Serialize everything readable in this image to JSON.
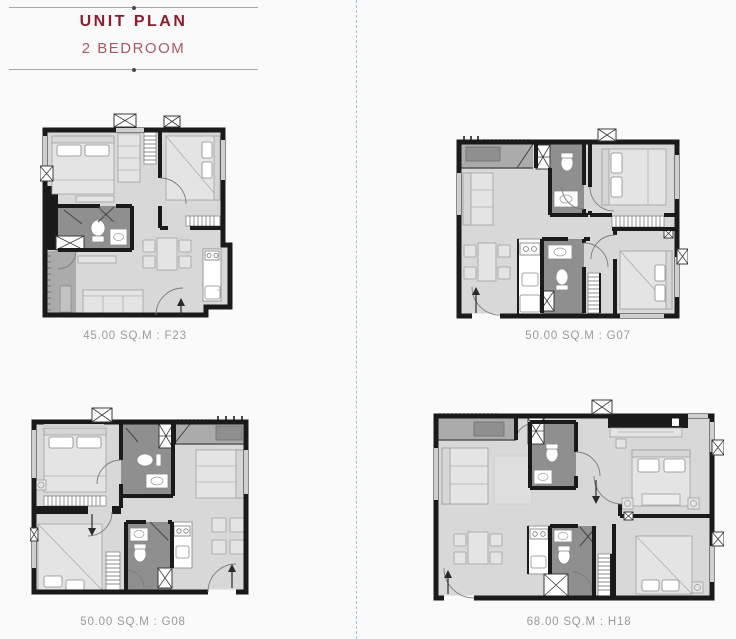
{
  "header": {
    "title": "UNIT PLAN",
    "subtitle": "2 BEDROOM"
  },
  "units": [
    {
      "area_sqm": "45.00",
      "unit_code": "F23",
      "caption": "45.00 SQ.M : F23"
    },
    {
      "area_sqm": "50.00",
      "unit_code": "G07",
      "caption": "50.00 SQ.M : G07"
    },
    {
      "area_sqm": "50.00",
      "unit_code": "G08",
      "caption": "50.00 SQ.M : G08"
    },
    {
      "area_sqm": "68.00",
      "unit_code": "H18",
      "caption": "68.00 SQ.M : H18"
    }
  ],
  "colors": {
    "title_primary": "#8e1c2c",
    "title_secondary": "#a85a66",
    "caption_text": "#9a9a9a",
    "divider_dashed": "#9cc4d6",
    "wall": "#1a1a1a",
    "floor": "#d8d8d8",
    "bathroom_floor": "#8f8f8f",
    "balcony_floor": "#ababab",
    "furniture": "#e4e4e4",
    "background": "#fafafa"
  }
}
